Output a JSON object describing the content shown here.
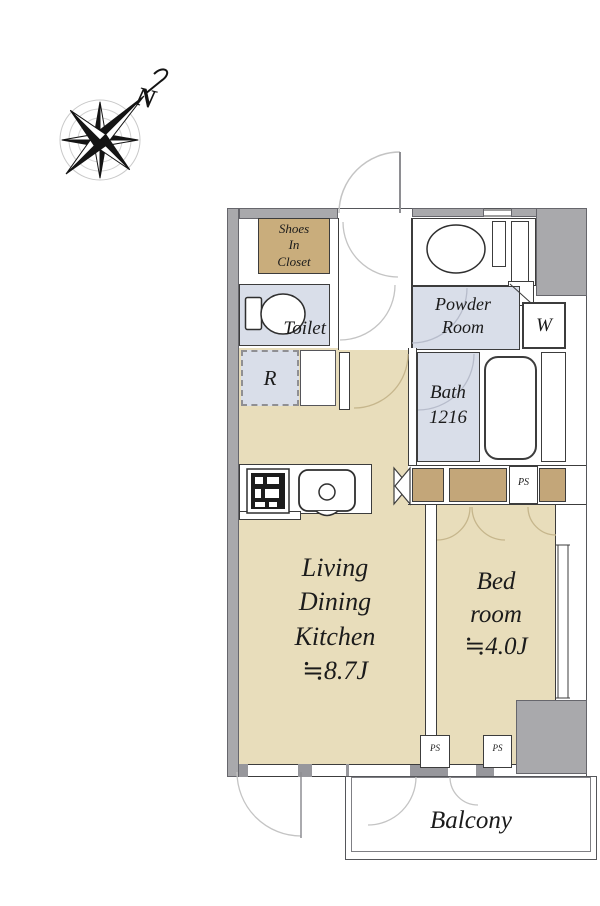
{
  "compass": {
    "north_label": "N"
  },
  "labels": {
    "shoes_closet": [
      "Shoes",
      "In",
      "Closet"
    ],
    "toilet": "Toilet",
    "powder_room": [
      "Powder",
      "Room"
    ],
    "washer": "W",
    "bath": [
      "Bath",
      "1216"
    ],
    "refrigerator": "R",
    "ldk": [
      "Living",
      "Dining",
      "Kitchen",
      "≒8.7J"
    ],
    "bedroom": [
      "Bed",
      "room",
      "≒4.0J"
    ],
    "balcony": "Balcony",
    "pipe_space": "PS"
  },
  "colors": {
    "floor_tan": "#e8ddbb",
    "closet_tan": "#c9ad7c",
    "wet_room_blue": "#d9dee9",
    "wall_gray": "#a9a9ac",
    "line_dark": "#3c3c3c",
    "door_arc_gray": "#c4c4c4",
    "door_arc_tan": "#c6b68c",
    "text": "#1b1b1b"
  }
}
